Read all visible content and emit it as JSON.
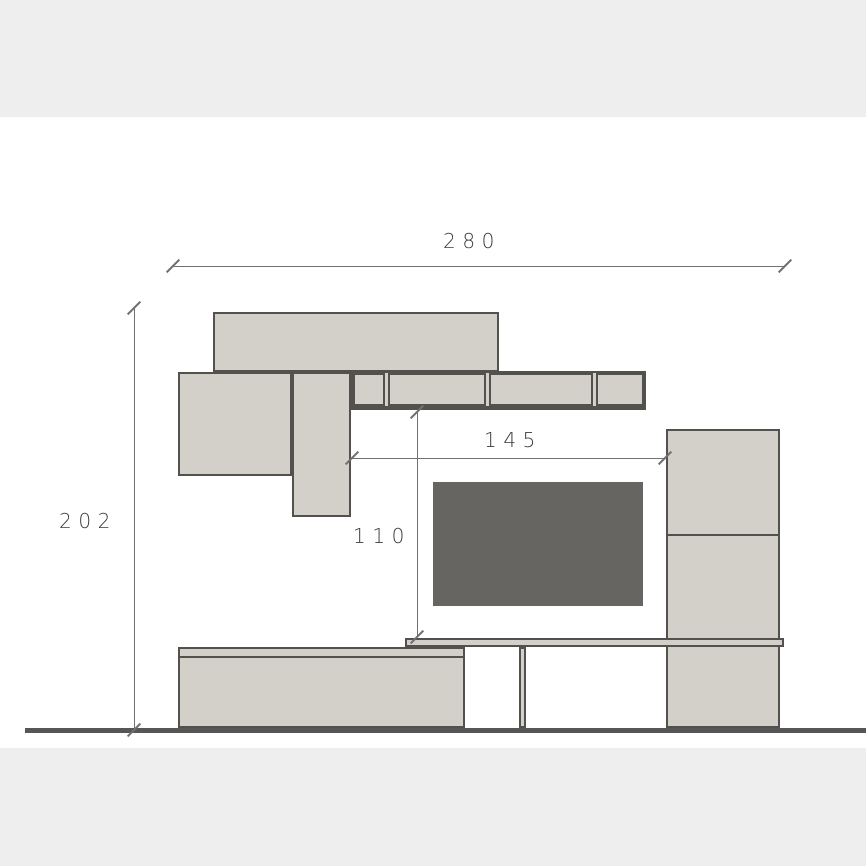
{
  "drawing": {
    "kind": "furniture-wall-unit-elevation",
    "dimensions": {
      "overall_width": "280",
      "overall_height": "202",
      "tv_alcove_width": "145",
      "tv_alcove_height": "110"
    }
  },
  "colors": {
    "band": "#eeeeee",
    "background": "#ffffff",
    "furniture_fill": "#d3d0ca",
    "outline": "#53514d",
    "tv_fill": "#676562",
    "floor": "#565656",
    "dim_line": "#707070",
    "dim_text": "#3b3b3b"
  }
}
